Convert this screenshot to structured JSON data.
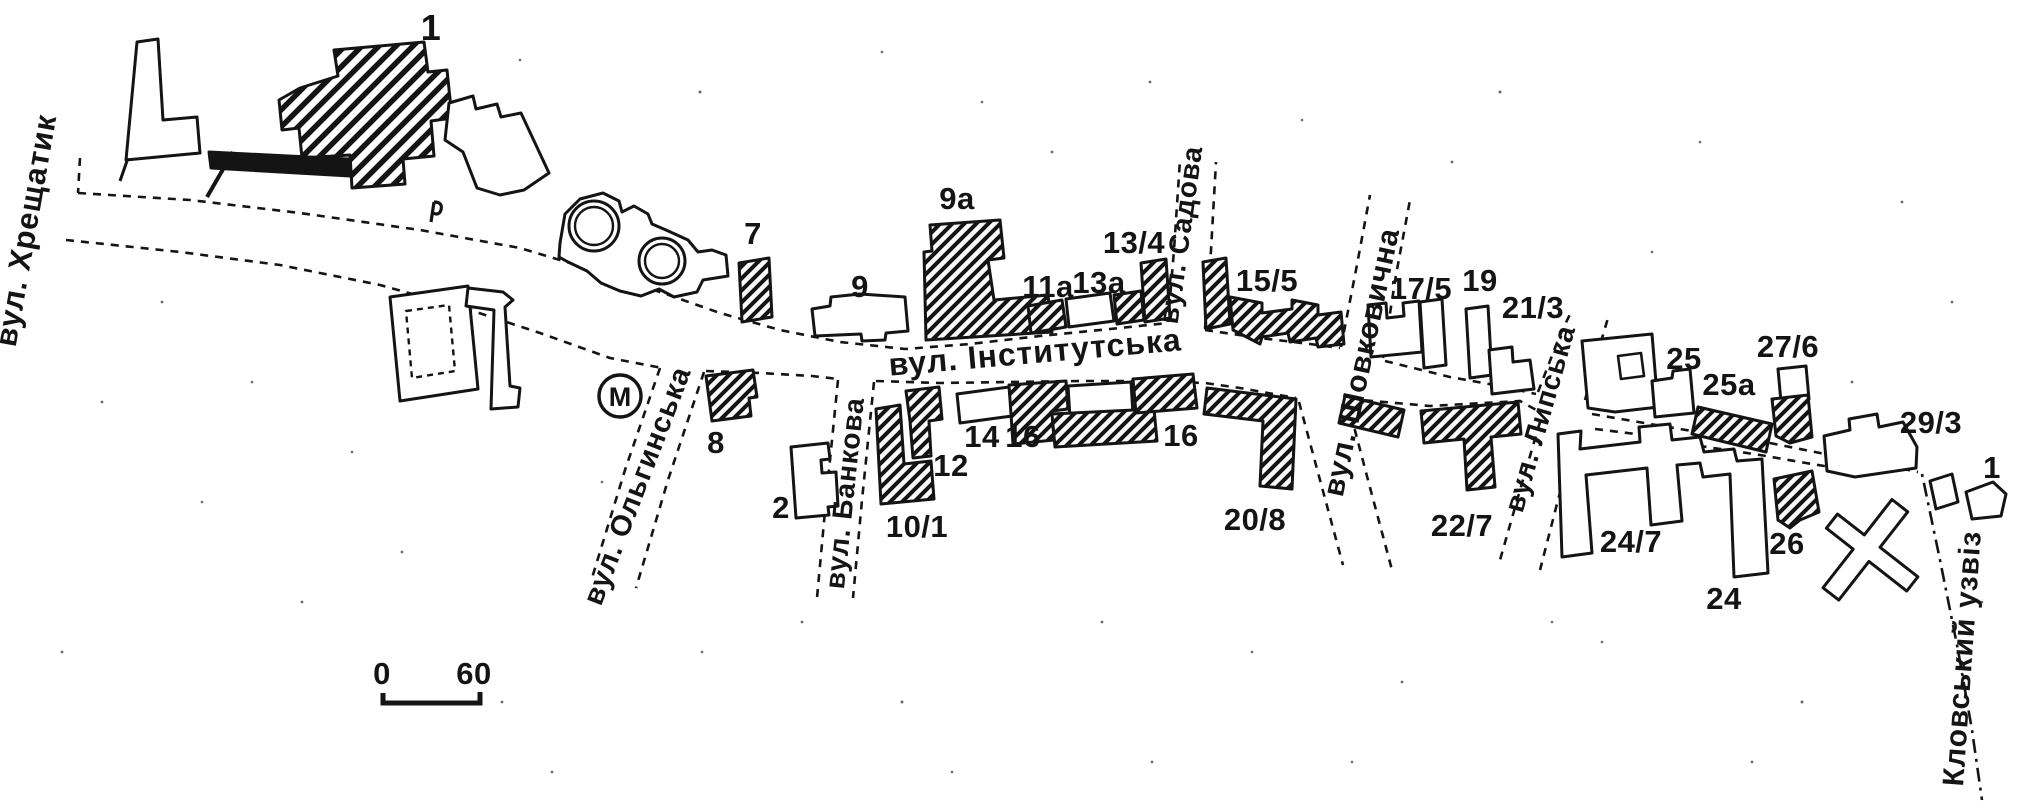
{
  "colors": {
    "ink": "#141414",
    "paper": "#ffffff"
  },
  "streets": [
    "вул. Хрещатик",
    "вул. Ольгинська",
    "вул. Банкова",
    "вул. Інститутська",
    "вул. Садова",
    "вул. Шовковична",
    "вул. Липська",
    "Кловський узвіз"
  ],
  "building_numbers": [
    "1",
    "7",
    "8",
    "9",
    "9а",
    "2",
    "10/1",
    "12",
    "14",
    "16",
    "16",
    "11а",
    "13а",
    "13/4",
    "15/5",
    "17/5",
    "19",
    "21/3",
    "20/8",
    "22/7",
    "24/7",
    "24",
    "26",
    "25",
    "25а",
    "27/6",
    "29/3",
    "1"
  ],
  "metro_label": "М",
  "scale_bar": {
    "start": "0",
    "end": "60"
  }
}
